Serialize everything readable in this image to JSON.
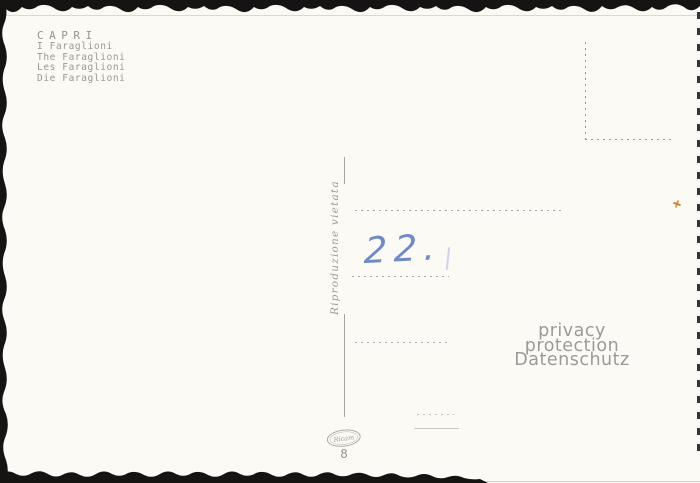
{
  "postcard": {
    "title": "CAPRI",
    "caption_lines": [
      "I Faraglioni",
      "The Faraglioni",
      "Les Faraglioni",
      "Die Faraglioni"
    ],
    "divider_text": "Riproduzione vietata",
    "handwritten_note": "22.",
    "publisher_logo": "Ricam",
    "card_number": "8",
    "watermark": {
      "line1": "privacy protection",
      "line2": "Datenschutz"
    },
    "colors": {
      "paper": "#fbfaf5",
      "printed_ink": "#9c978c",
      "divider_ink": "#a6a699",
      "address_dots": "#a6abb3",
      "handwriting_blue": "#5f7fbe",
      "watermark_gray": "#8a8a8a",
      "speck_orange": "#c5882f",
      "edge_black": "#151412"
    }
  }
}
